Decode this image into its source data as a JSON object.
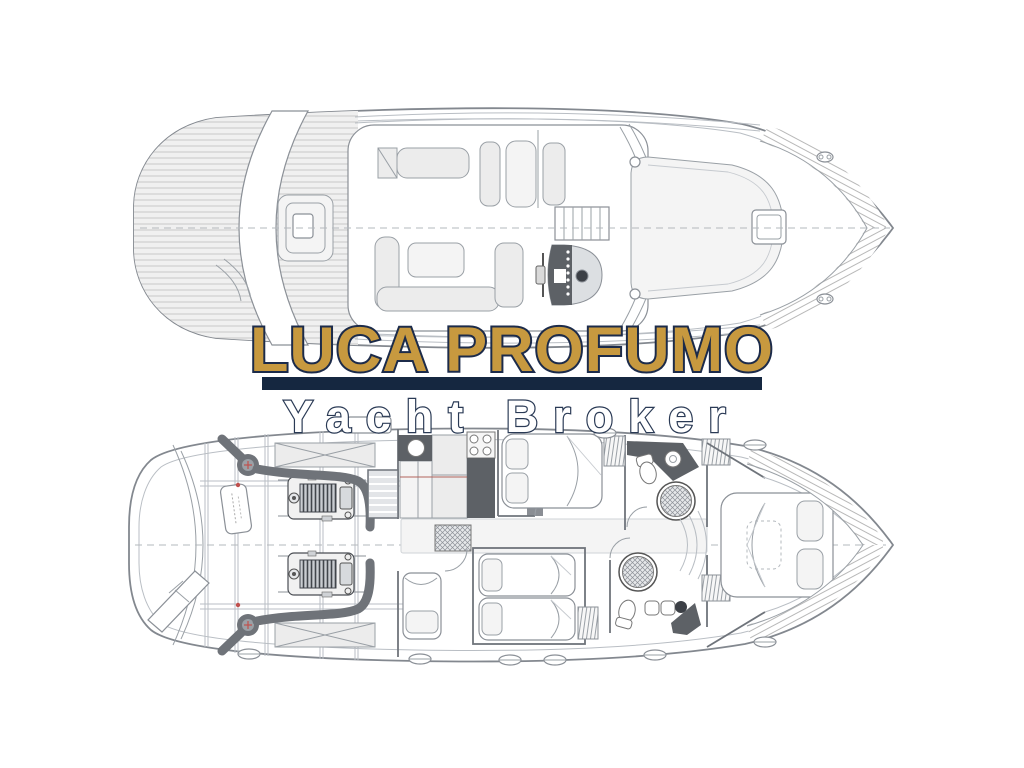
{
  "page": {
    "background": "#FFFFFF",
    "description": "Yacht broker watermark over two yacht deck floor plans"
  },
  "watermark": {
    "title": "LUCA PROFUMO",
    "subtitle": "Yacht Broker",
    "colors": {
      "title_fill": "#C7993F",
      "title_outline": "#1C2B4A",
      "divider_bar": "#152740",
      "subtitle_fill": "#FFFFFF",
      "subtitle_outline": "#2A3A55"
    }
  },
  "plans": {
    "upper_deck": {
      "label": "main-deck-plan",
      "features": [
        "aft-teak-cockpit",
        "radar-arch-walkway",
        "cockpit-engine-hatch",
        "salon-dinette",
        "u-shaped-sofa",
        "helm-station-with-wheel",
        "flybridge-stairs",
        "windscreen",
        "foredeck-sunpad",
        "foredeck-hatch",
        "bow-planking",
        "cleats"
      ]
    },
    "lower_deck": {
      "label": "lower-deck-plan",
      "features": [
        "swim-ladder",
        "engine-room",
        "twin-engines",
        "exhaust-silencers",
        "tank-label",
        "companionway-stairs",
        "galley-with-stove-and-sink",
        "mid-double-cabin",
        "twin-guest-cabin",
        "single-berth-cabin",
        "two-bathrooms-with-round-showers",
        "wardrobes",
        "vip-bow-cabin",
        "portholes"
      ]
    }
  }
}
